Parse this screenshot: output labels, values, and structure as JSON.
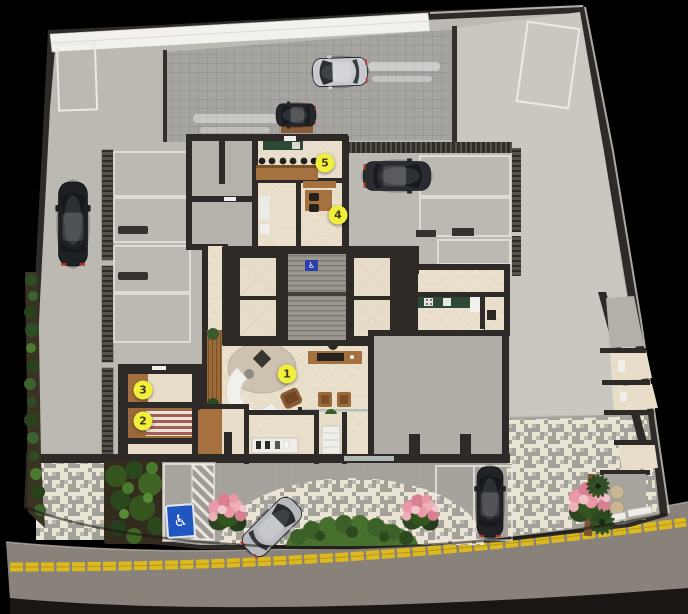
{
  "plan": {
    "markers": [
      {
        "id": "1",
        "label": "1"
      },
      {
        "id": "2",
        "label": "2"
      },
      {
        "id": "3",
        "label": "3"
      },
      {
        "id": "4",
        "label": "4"
      },
      {
        "id": "5",
        "label": "5"
      }
    ],
    "signs": {
      "accessible_parking_icon": "♿",
      "elevator_hall_icon": "♿"
    },
    "colors": {
      "marker_bg": "#f2ee3c",
      "marker_text": "#3f3c12",
      "road_line_yellow": "#dcb91f",
      "accessible_sign_blue": "#2156c0",
      "wall_dark": "#2d2a27",
      "garage_floor": "#bcb9b3",
      "open_court_floor": "#cac7c1",
      "lobby_floor": "#e8ddc8",
      "wood": "#a5713e",
      "counter_green": "#2e4a35",
      "pavement_cream": "#eae4d4",
      "pavement_gray": "#a3a099",
      "garden_green": "#35551f",
      "flower_pink": "#e898a6",
      "asphalt": "#89827a"
    }
  }
}
